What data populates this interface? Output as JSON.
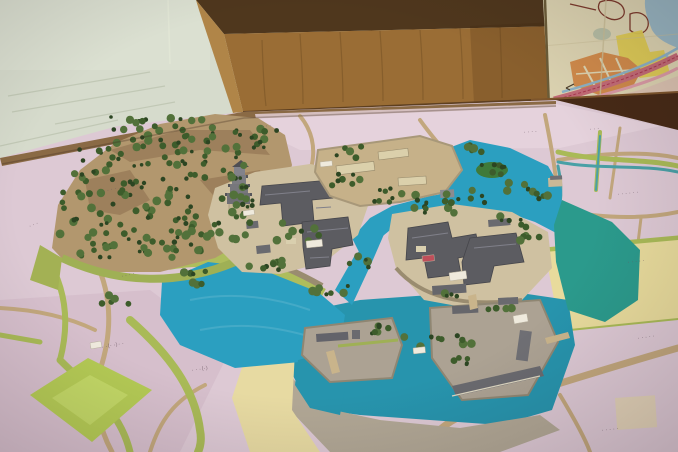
{
  "palette": {
    "wall": "#d6dbcc",
    "cabinet_top": "#4f371d",
    "cabinet_face": "#9a6d35",
    "cabinet_edge": "#b08548",
    "map_paper": "#dbd2b0",
    "rail": "#472a16",
    "wood_edge": "#8a6a45",
    "town_pink": "#ddc9d4",
    "pink_light": "#e7d5dd",
    "pink_deep": "#d3bac9",
    "road_tan": "#c2a77d",
    "grass": "#a9ba57",
    "slope_green": "#aebd5c",
    "water_blue": "#2b9fc0",
    "water_moat": "#2794ad",
    "water_teal": "#2b9a8c",
    "stream": "#49a0a6",
    "hill_tan": "#b2976e",
    "hill_shadow": "#8d6f4e",
    "tree_dark": "#2c4522",
    "tree_mid": "#3d5c2b",
    "tree_light": "#52713a",
    "plateau": "#cfc1a1",
    "yard": "#c6b189",
    "ground_gray": "#aca293",
    "shore_gray": "#b1a795",
    "roof": "#5c5c61",
    "roof_light": "#80808a",
    "cream_wall": "#dbd0ab",
    "stone": "#9a8c70",
    "field_yellow": "#e8db9c",
    "field_cream": "#e7daa2",
    "diamond_green": "#b4ca55",
    "tag_white": "#efeadd",
    "tag_red": "#bf4f5a",
    "label_ink": "#6e5a66",
    "island_green": "#3f7a3a"
  },
  "labels": {
    "plots": [
      {
        "text": "· · · ·",
        "x": 104,
        "y": 193,
        "rot": -14
      },
      {
        "text": "· · ·",
        "x": 30,
        "y": 228,
        "rot": -22
      },
      {
        "text": "· · · ·",
        "x": 122,
        "y": 278,
        "rot": -14
      },
      {
        "text": "· ·（· ·）· ·",
        "x": 102,
        "y": 349,
        "rot": -10
      },
      {
        "text": "· · ·（·）",
        "x": 192,
        "y": 372,
        "rot": -8
      },
      {
        "text": "· · · ·",
        "x": 524,
        "y": 134,
        "rot": -4
      },
      {
        "text": "· · ·",
        "x": 590,
        "y": 131,
        "rot": -4
      },
      {
        "text": "· · · · · ·",
        "x": 618,
        "y": 196,
        "rot": -6
      },
      {
        "text": "· · · · ·",
        "x": 628,
        "y": 264,
        "rot": -6
      },
      {
        "text": "· · · · ·",
        "x": 638,
        "y": 340,
        "rot": -8
      },
      {
        "text": "· · · · ·",
        "x": 602,
        "y": 432,
        "rot": -6
      },
      {
        "text": "· · ·",
        "x": 262,
        "y": 128,
        "rot": -4
      }
    ],
    "tags": [
      {
        "x": 243,
        "y": 211,
        "w": 11,
        "h": 5,
        "rot": -8,
        "color": "white"
      },
      {
        "x": 306,
        "y": 241,
        "w": 16,
        "h": 7,
        "rot": -6,
        "color": "white"
      },
      {
        "x": 320,
        "y": 162,
        "w": 12,
        "h": 5,
        "rot": -6,
        "color": "white"
      },
      {
        "x": 449,
        "y": 273,
        "w": 17,
        "h": 8,
        "rot": -8,
        "color": "white"
      },
      {
        "x": 513,
        "y": 316,
        "w": 14,
        "h": 8,
        "rot": -10,
        "color": "white"
      },
      {
        "x": 413,
        "y": 348,
        "w": 12,
        "h": 6,
        "rot": -6,
        "color": "white"
      },
      {
        "x": 90,
        "y": 343,
        "w": 11,
        "h": 6,
        "rot": -10,
        "color": "white"
      },
      {
        "x": 422,
        "y": 256,
        "w": 12,
        "h": 6,
        "rot": -6,
        "color": "red"
      }
    ]
  },
  "trees": {
    "clusters": [
      [
        163,
        133,
        52,
        16,
        36
      ],
      [
        112,
        166,
        38,
        20,
        26
      ],
      [
        202,
        163,
        42,
        18,
        26
      ],
      [
        146,
        205,
        48,
        20,
        30
      ],
      [
        210,
        232,
        40,
        18,
        24
      ],
      [
        108,
        243,
        32,
        16,
        18
      ],
      [
        250,
        137,
        28,
        11,
        14
      ],
      [
        76,
        212,
        18,
        22,
        12
      ],
      [
        240,
        196,
        18,
        10,
        10
      ],
      [
        172,
        248,
        30,
        12,
        14
      ],
      [
        298,
        232,
        22,
        9,
        8
      ],
      [
        262,
        262,
        24,
        9,
        9
      ],
      [
        240,
        210,
        12,
        6,
        5
      ],
      [
        330,
        288,
        18,
        7,
        7
      ],
      [
        360,
        262,
        12,
        6,
        5
      ],
      [
        345,
        180,
        22,
        8,
        7
      ],
      [
        390,
        196,
        30,
        8,
        10
      ],
      [
        428,
        205,
        26,
        8,
        9
      ],
      [
        465,
        196,
        20,
        7,
        7
      ],
      [
        350,
        152,
        14,
        6,
        5
      ],
      [
        492,
        170,
        14,
        6,
        7
      ],
      [
        470,
        146,
        16,
        6,
        6
      ],
      [
        520,
        186,
        14,
        6,
        6
      ],
      [
        545,
        195,
        10,
        5,
        4
      ],
      [
        512,
        222,
        16,
        6,
        6
      ],
      [
        530,
        238,
        12,
        6,
        5
      ],
      [
        445,
        296,
        12,
        5,
        4
      ],
      [
        392,
        332,
        20,
        7,
        8
      ],
      [
        430,
        342,
        14,
        6,
        5
      ],
      [
        465,
        340,
        12,
        5,
        4
      ],
      [
        500,
        312,
        12,
        5,
        4
      ],
      [
        188,
        278,
        20,
        8,
        7
      ],
      [
        115,
        300,
        14,
        6,
        5
      ],
      [
        470,
        360,
        16,
        6,
        5
      ]
    ]
  }
}
